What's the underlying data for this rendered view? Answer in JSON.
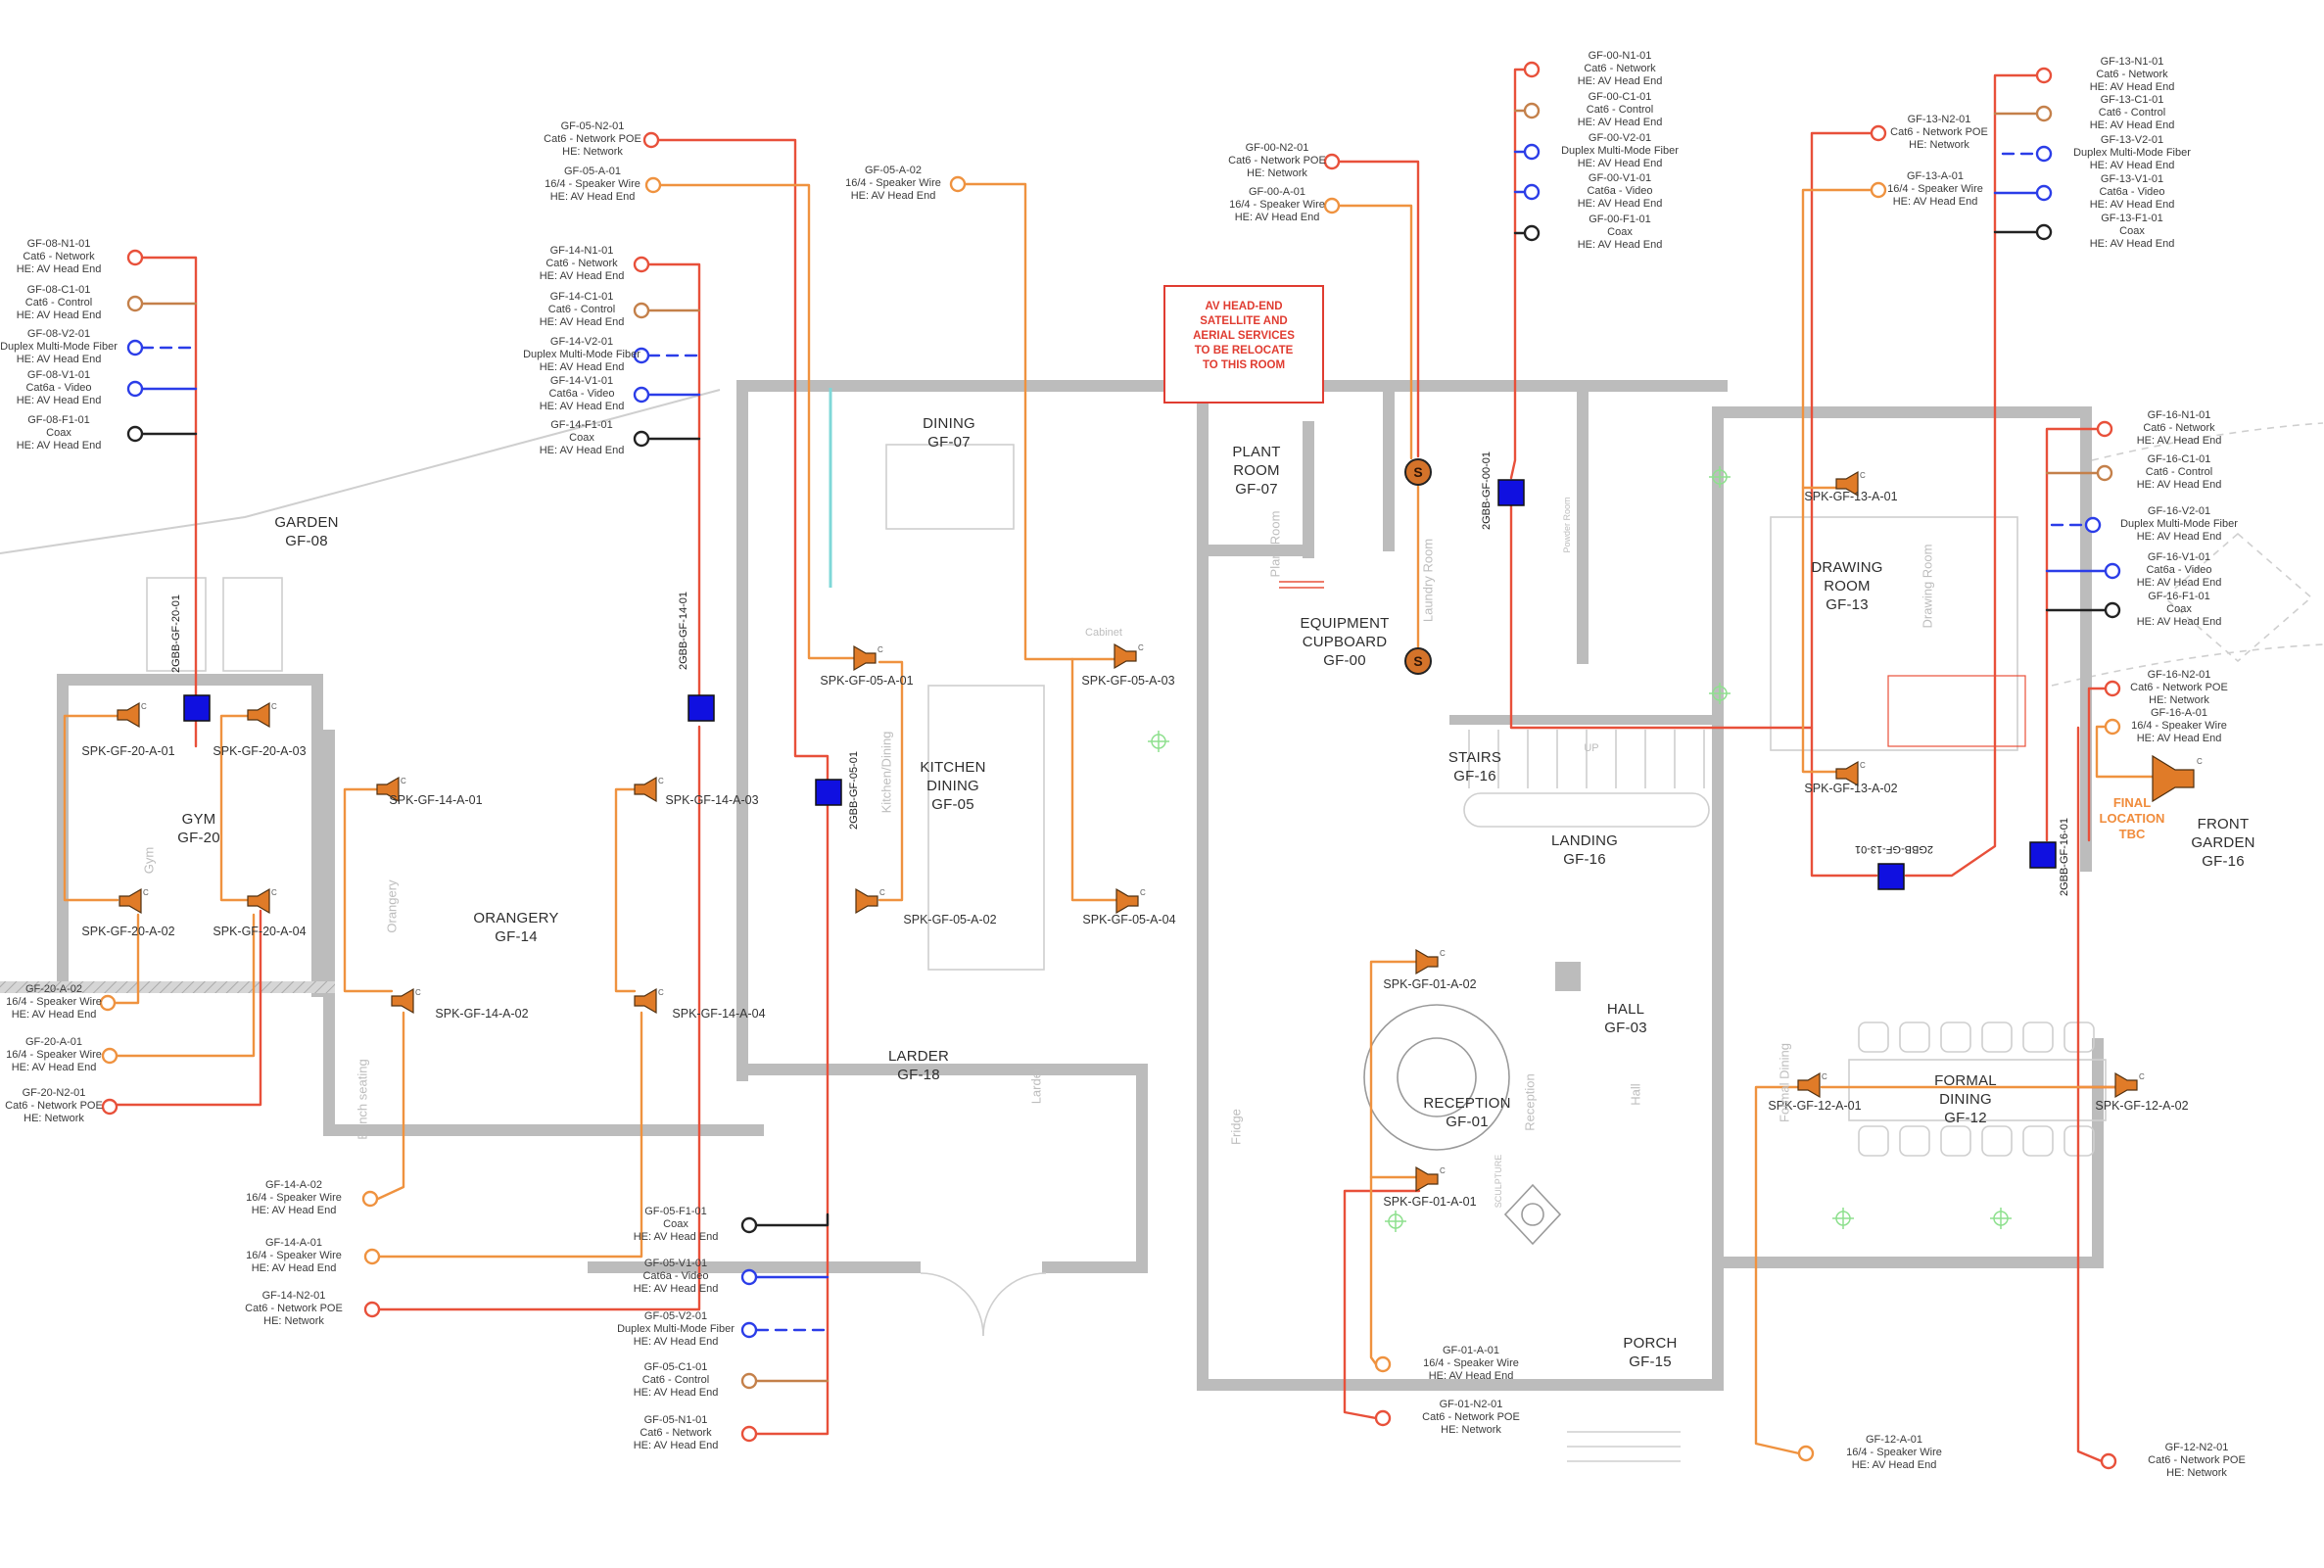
{
  "title": "Ground floor AV / cabling plan",
  "glyphs": {
    "c": "C",
    "s": "S"
  },
  "colors": {
    "wire_network": "#e8503a",
    "wire_speaker": "#ef923f",
    "wire_control": "#c4804a",
    "wire_video": "#2b3de8",
    "wire_fiber_dashed": "#2b3de8",
    "wire_coax": "#222222",
    "junction_box_blue": "#1010e0",
    "device_orange": "#d4732a",
    "note_red": "#e03c31",
    "final_orange": "#f08c3c"
  },
  "notes": {
    "relocate": {
      "l1": "AV HEAD-END",
      "l2": "SATELLITE AND",
      "l3": "AERIAL SERVICES",
      "l4": "TO BE RELOCATE",
      "l5": "TO THIS ROOM"
    },
    "final": {
      "l1": "FINAL",
      "l2": "LOCATION",
      "l3": "TBC"
    }
  },
  "rooms": {
    "garden": {
      "l1": "GARDEN",
      "l2": "GF-08"
    },
    "gym": {
      "l1": "GYM",
      "l2": "GF-20"
    },
    "orangery": {
      "l1": "ORANGERY",
      "l2": "GF-14"
    },
    "dining": {
      "l1": "DINING",
      "l2": "GF-07"
    },
    "kitchen": {
      "l1": "KITCHEN",
      "l2": "DINING",
      "l3": "GF-05"
    },
    "larder": {
      "l1": "LARDER",
      "l2": "GF-18"
    },
    "plant": {
      "l1": "PLANT",
      "l2": "ROOM",
      "l3": "GF-07"
    },
    "equipment": {
      "l1": "EQUIPMENT",
      "l2": "CUPBOARD",
      "l3": "GF-00"
    },
    "stairs": {
      "l1": "STAIRS",
      "l2": "GF-16"
    },
    "landing": {
      "l1": "LANDING",
      "l2": "GF-16"
    },
    "hall": {
      "l1": "HALL",
      "l2": "GF-03"
    },
    "reception": {
      "l1": "RECEPTION",
      "l2": "GF-01"
    },
    "porch": {
      "l1": "PORCH",
      "l2": "GF-15"
    },
    "drawing": {
      "l1": "DRAWING",
      "l2": "ROOM",
      "l3": "GF-13"
    },
    "formal": {
      "l1": "FORMAL",
      "l2": "DINING",
      "l3": "GF-12"
    },
    "front_garden": {
      "l1": "FRONT",
      "l2": "GARDEN",
      "l3": "GF-16"
    }
  },
  "plan_text": {
    "gym": "Gym",
    "orangery": "Orangery",
    "bench": "Bench seating",
    "kitchen": "Kitchen/Dining",
    "larder": "Larder",
    "fridge": "Fridge",
    "plant": "Plant Room",
    "laundry": "Laundry Room",
    "powder": "Powder Room",
    "reception": "Reception",
    "hall": "Hall",
    "sculpture": "SCULPTURE",
    "drawing": "Drawing Room",
    "formal": "Formal Dining",
    "up": "UP",
    "cabinet": "Cabinet"
  },
  "speakers": {
    "s2001": "SPK-GF-20-A-01",
    "s2003": "SPK-GF-20-A-03",
    "s2002": "SPK-GF-20-A-02",
    "s2004": "SPK-GF-20-A-04",
    "s1401": "SPK-GF-14-A-01",
    "s1403": "SPK-GF-14-A-03",
    "s1402": "SPK-GF-14-A-02",
    "s1404": "SPK-GF-14-A-04",
    "s0501": "SPK-GF-05-A-01",
    "s0503": "SPK-GF-05-A-03",
    "s0502": "SPK-GF-05-A-02",
    "s0504": "SPK-GF-05-A-04",
    "s0102": "SPK-GF-01-A-02",
    "s0101": "SPK-GF-01-A-01",
    "s1301": "SPK-GF-13-A-01",
    "s1302": "SPK-GF-13-A-02",
    "s1201": "SPK-GF-12-A-01",
    "s1202": "SPK-GF-12-A-02"
  },
  "boxes": {
    "b20": "2GBB-GF-20-01",
    "b14": "2GBB-GF-14-01",
    "b05": "2GBB-GF-05-01",
    "b00": "2GBB-GF-00-01",
    "b13": "2GBB-GF-13-01",
    "b16": "2GBB-GF-16-01"
  },
  "callouts": {
    "gf08_n1": {
      "id": "GF-08-N1-01",
      "cable": "Cat6 - Network",
      "he": "HE: AV Head End"
    },
    "gf08_c1": {
      "id": "GF-08-C1-01",
      "cable": "Cat6 - Control",
      "he": "HE: AV Head End"
    },
    "gf08_v2": {
      "id": "GF-08-V2-01",
      "cable": "Duplex Multi-Mode Fiber",
      "he": "HE: AV Head End"
    },
    "gf08_v1": {
      "id": "GF-08-V1-01",
      "cable": "Cat6a - Video",
      "he": "HE: AV Head End"
    },
    "gf08_f1": {
      "id": "GF-08-F1-01",
      "cable": "Coax",
      "he": "HE: AV Head End"
    },
    "gf05_n2": {
      "id": "GF-05-N2-01",
      "cable": "Cat6 - Network POE",
      "he": "HE: Network"
    },
    "gf05_a1": {
      "id": "GF-05-A-01",
      "cable": "16/4 - Speaker Wire",
      "he": "HE: AV Head End"
    },
    "gf05_a2": {
      "id": "GF-05-A-02",
      "cable": "16/4 - Speaker Wire",
      "he": "HE: AV Head End"
    },
    "gf14_n1": {
      "id": "GF-14-N1-01",
      "cable": "Cat6 - Network",
      "he": "HE: AV Head End"
    },
    "gf14_c1": {
      "id": "GF-14-C1-01",
      "cable": "Cat6 - Control",
      "he": "HE: AV Head End"
    },
    "gf14_v2": {
      "id": "GF-14-V2-01",
      "cable": "Duplex Multi-Mode Fiber",
      "he": "HE: AV Head End"
    },
    "gf14_v1": {
      "id": "GF-14-V1-01",
      "cable": "Cat6a - Video",
      "he": "HE: AV Head End"
    },
    "gf14_f1": {
      "id": "GF-14-F1-01",
      "cable": "Coax",
      "he": "HE: AV Head End"
    },
    "gf00_n2": {
      "id": "GF-00-N2-01",
      "cable": "Cat6 - Network POE",
      "he": "HE: Network"
    },
    "gf00_a1": {
      "id": "GF-00-A-01",
      "cable": "16/4 - Speaker Wire",
      "he": "HE: AV Head End"
    },
    "gf00_n1": {
      "id": "GF-00-N1-01",
      "cable": "Cat6 - Network",
      "he": "HE: AV Head End"
    },
    "gf00_c1": {
      "id": "GF-00-C1-01",
      "cable": "Cat6 - Control",
      "he": "HE: AV Head End"
    },
    "gf00_v2": {
      "id": "GF-00-V2-01",
      "cable": "Duplex Multi-Mode Fiber",
      "he": "HE: AV Head End"
    },
    "gf00_v1": {
      "id": "GF-00-V1-01",
      "cable": "Cat6a - Video",
      "he": "HE: AV Head End"
    },
    "gf00_f1": {
      "id": "GF-00-F1-01",
      "cable": "Coax",
      "he": "HE: AV Head End"
    },
    "gf13_n2": {
      "id": "GF-13-N2-01",
      "cable": "Cat6 - Network POE",
      "he": "HE: Network"
    },
    "gf13_a1": {
      "id": "GF-13-A-01",
      "cable": "16/4 - Speaker Wire",
      "he": "HE: AV Head End"
    },
    "gf13_n1": {
      "id": "GF-13-N1-01",
      "cable": "Cat6 - Network",
      "he": "HE: AV Head End"
    },
    "gf13_c1": {
      "id": "GF-13-C1-01",
      "cable": "Cat6 - Control",
      "he": "HE: AV Head End"
    },
    "gf13_v2": {
      "id": "GF-13-V2-01",
      "cable": "Duplex Multi-Mode Fiber",
      "he": "HE: AV Head End"
    },
    "gf13_v1": {
      "id": "GF-13-V1-01",
      "cable": "Cat6a - Video",
      "he": "HE: AV Head End"
    },
    "gf13_f1": {
      "id": "GF-13-F1-01",
      "cable": "Coax",
      "he": "HE: AV Head End"
    },
    "gf16_n1": {
      "id": "GF-16-N1-01",
      "cable": "Cat6 - Network",
      "he": "HE: AV Head End"
    },
    "gf16_c1": {
      "id": "GF-16-C1-01",
      "cable": "Cat6 - Control",
      "he": "HE: AV Head End"
    },
    "gf16_v2": {
      "id": "GF-16-V2-01",
      "cable": "Duplex Multi-Mode Fiber",
      "he": "HE: AV Head End"
    },
    "gf16_v1": {
      "id": "GF-16-V1-01",
      "cable": "Cat6a - Video",
      "he": "HE: AV Head End"
    },
    "gf16_f1": {
      "id": "GF-16-F1-01",
      "cable": "Coax",
      "he": "HE: AV Head End"
    },
    "gf16_n2": {
      "id": "GF-16-N2-01",
      "cable": "Cat6 - Network POE",
      "he": "HE: Network"
    },
    "gf16_a1": {
      "id": "GF-16-A-01",
      "cable": "16/4 - Speaker Wire",
      "he": "HE: AV Head End"
    },
    "gf20_a2": {
      "id": "GF-20-A-02",
      "cable": "16/4 - Speaker Wire",
      "he": "HE: AV Head End"
    },
    "gf20_a1": {
      "id": "GF-20-A-01",
      "cable": "16/4 - Speaker Wire",
      "he": "HE: AV Head End"
    },
    "gf20_n2": {
      "id": "GF-20-N2-01",
      "cable": "Cat6 - Network POE",
      "he": "HE: Network"
    },
    "gf14_a2": {
      "id": "GF-14-A-02",
      "cable": "16/4 - Speaker Wire",
      "he": "HE: AV Head End"
    },
    "gf14_a1": {
      "id": "GF-14-A-01",
      "cable": "16/4 - Speaker Wire",
      "he": "HE: AV Head End"
    },
    "gf14_n2": {
      "id": "GF-14-N2-01",
      "cable": "Cat6 - Network POE",
      "he": "HE: Network"
    },
    "gf05_f1": {
      "id": "GF-05-F1-01",
      "cable": "Coax",
      "he": "HE: AV Head End"
    },
    "gf05_v1": {
      "id": "GF-05-V1-01",
      "cable": "Cat6a - Video",
      "he": "HE: AV Head End"
    },
    "gf05_v2": {
      "id": "GF-05-V2-01",
      "cable": "Duplex Multi-Mode Fiber",
      "he": "HE: AV Head End"
    },
    "gf05_c1": {
      "id": "GF-05-C1-01",
      "cable": "Cat6 - Control",
      "he": "HE: AV Head End"
    },
    "gf05_n1": {
      "id": "GF-05-N1-01",
      "cable": "Cat6 - Network",
      "he": "HE: AV Head End"
    },
    "gf01_a1": {
      "id": "GF-01-A-01",
      "cable": "16/4 - Speaker Wire",
      "he": "HE: AV Head End"
    },
    "gf01_n2": {
      "id": "GF-01-N2-01",
      "cable": "Cat6 - Network POE",
      "he": "HE: Network"
    },
    "gf12_a1": {
      "id": "GF-12-A-01",
      "cable": "16/4 - Speaker Wire",
      "he": "HE: AV Head End"
    },
    "gf12_n2": {
      "id": "GF-12-N2-01",
      "cable": "Cat6 - Network POE",
      "he": "HE: Network"
    }
  }
}
